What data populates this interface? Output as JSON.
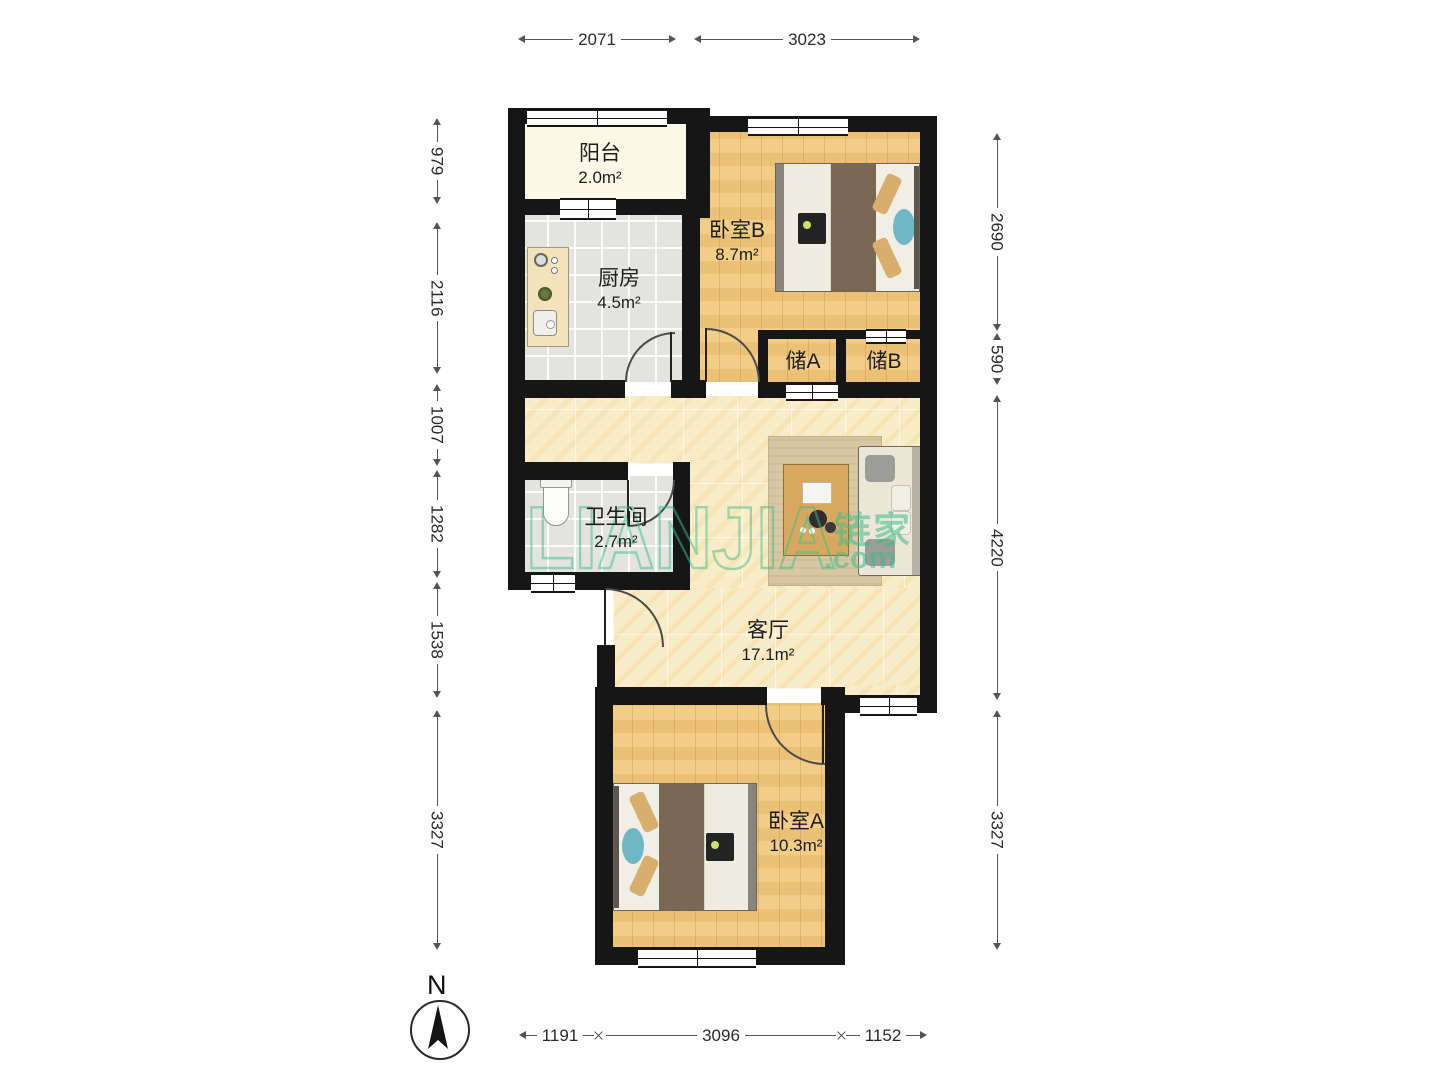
{
  "plan": {
    "rooms": {
      "balcony": {
        "name": "阳台",
        "area": "2.0m²"
      },
      "kitchen": {
        "name": "厨房",
        "area": "4.5m²"
      },
      "bedroom_b": {
        "name": "卧室B",
        "area": "8.7m²"
      },
      "storage_a": {
        "name": "储A"
      },
      "storage_b": {
        "name": "储B"
      },
      "bathroom": {
        "name": "卫生间",
        "area": "2.7m²"
      },
      "living_room": {
        "name": "客厅",
        "area": "17.1m²"
      },
      "bedroom_a": {
        "name": "卧室A",
        "area": "10.3m²"
      }
    },
    "dims": {
      "top": [
        "2071",
        "3023"
      ],
      "left": [
        "979",
        "2116",
        "1007",
        "1282",
        "1538",
        "3327"
      ],
      "right": [
        "2690",
        "590",
        "4220",
        "3327"
      ],
      "bottom": [
        "1191",
        "3096",
        "1152"
      ]
    },
    "compass": {
      "north_label": "N"
    },
    "watermark": {
      "brand": "LIANJIA",
      "brand_cjk": "链家",
      "brand_suffix": ".com"
    }
  },
  "colors": {
    "wall": "#161616",
    "wood": "#f0c87e",
    "tile": "#e3e3e0",
    "marble": "#f9edc9",
    "balcony": "#fbf8e6",
    "rug": "#d9c7a2",
    "table_wood": "#d8a85f",
    "blanket": "#796853",
    "pillow_tan": "#d8ae6c",
    "pillow_teal": "#6fb7c4",
    "watermark": "#3dbe8b"
  }
}
